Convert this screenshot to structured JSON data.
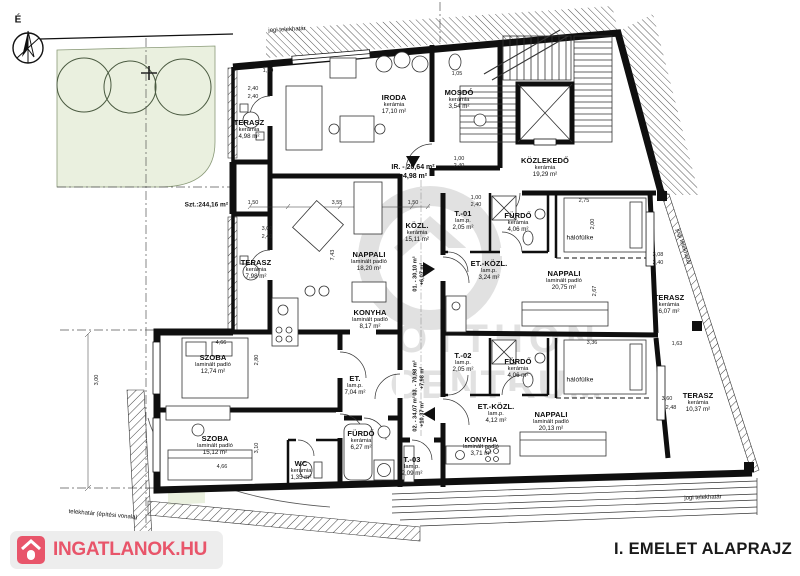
{
  "page_title": "I. EMELET ALAPRAJZ",
  "brand": {
    "logo_text": "INGATLANOK.HU"
  },
  "compass": {
    "north_label": "É"
  },
  "site": {
    "garden_area_label": "Szt.:244,16 m²",
    "boundary_top": "jogi telekhatár",
    "boundary_right": "jogi telekhatár",
    "boundary_bottom_right": "jogi telekhatár",
    "boundary_bottom_left": "telekhatár (építési vonala)"
  },
  "watermark": {
    "line1": "OTTHON",
    "line2": "CENTRUM"
  },
  "unit_totals": {
    "office": {
      "line1": "IR. - 20,64 m²",
      "line2": "+4,98 m²"
    },
    "u01": {
      "line1": "01. - 30,10 m²",
      "line2": "+6,07 m²"
    },
    "u02": {
      "line1": "02. - 34,07 m²",
      "line2": "+10,37 m²"
    },
    "u03": {
      "line1": "03. - 70,98 m²",
      "line2": "+7,98 m²"
    }
  },
  "rooms": [
    {
      "name": "TERASZ",
      "material": "kerámia",
      "area": "4,98 m²"
    },
    {
      "name": "IRODA",
      "material": "kerámia",
      "area": "17,10 m²"
    },
    {
      "name": "MOSDÓ",
      "material": "kerámia",
      "area": "3,54 m²"
    },
    {
      "name": "KÖZLEKEDŐ",
      "material": "kerámia",
      "area": "19,29 m²"
    },
    {
      "name": "TERASZ",
      "material": "kerámia",
      "area": "7,98 m²"
    },
    {
      "name": "NAPPALI",
      "material": "laminált padló",
      "area": "18,20 m²"
    },
    {
      "name": "KONYHA",
      "material": "laminált padló",
      "area": "8,17 m²"
    },
    {
      "name": "KÖZL.",
      "material": "kerámia",
      "area": "15,11 m²"
    },
    {
      "name": "T.-01",
      "material": "lam.p.",
      "area": "2,05 m²"
    },
    {
      "name": "FÜRDŐ",
      "material": "kerámia",
      "area": "4,06 m²"
    },
    {
      "name": "hálófülke",
      "material": "",
      "area": ""
    },
    {
      "name": "ET.-KÖZL.",
      "material": "lam.p.",
      "area": "3,24 m²"
    },
    {
      "name": "NAPPALI",
      "material": "laminált padló",
      "area": "20,75 m²"
    },
    {
      "name": "TERASZ",
      "material": "kerámia",
      "area": "6,07 m²"
    },
    {
      "name": "T.-02",
      "material": "lam.p.",
      "area": "2,05 m²"
    },
    {
      "name": "FÜRDŐ",
      "material": "kerámia",
      "area": "4,06 m²"
    },
    {
      "name": "hálófülke",
      "material": "",
      "area": ""
    },
    {
      "name": "ET.-KÖZL.",
      "material": "lam.p.",
      "area": "4,12 m²"
    },
    {
      "name": "NAPPALI",
      "material": "laminált padló",
      "area": "20,13 m²"
    },
    {
      "name": "KONYHA",
      "material": "laminált padló",
      "area": "3,71 m²"
    },
    {
      "name": "TERASZ",
      "material": "kerámia",
      "area": "10,37 m²"
    },
    {
      "name": "SZOBA",
      "material": "laminált padló",
      "area": "12,74 m²"
    },
    {
      "name": "SZOBA",
      "material": "laminált padló",
      "area": "15,12 m²"
    },
    {
      "name": "ET.",
      "material": "lam.p.",
      "area": "7,04 m²"
    },
    {
      "name": "FÜRDŐ",
      "material": "kerámia",
      "area": "6,27 m²"
    },
    {
      "name": "WC",
      "material": "kerámia",
      "area": "1,35 m²"
    },
    {
      "name": "T.-03",
      "material": "lam.p.",
      "area": "2,09 m²"
    }
  ],
  "dimensions": [
    "1,50",
    "2,40",
    "2,40",
    "1,05",
    "2,75",
    "2,00",
    "2,67",
    "3,36",
    "3,55",
    "1,50",
    "1,50",
    "3,00",
    "2,40",
    "7,43",
    "4,66",
    "2,80",
    "3,10",
    "4,66",
    "3,00",
    "3,08",
    "2,40",
    "1,63",
    "3,60",
    "2,48",
    "1,00",
    "2,40",
    "1,00",
    "2,40"
  ],
  "colors": {
    "accent_red": "#e8556a",
    "garden_green": "#eaf0df",
    "wall_black": "#0f0f0f",
    "watermark_gray": "#c4c4c4"
  }
}
